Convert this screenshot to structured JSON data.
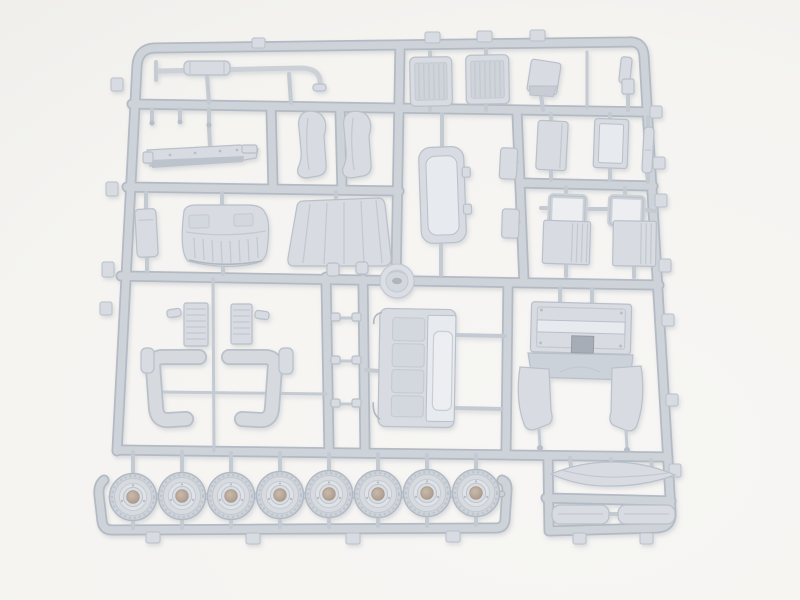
{
  "scene": {
    "type": "product-photo",
    "subject": "plastic-model-kit-sprue",
    "description": "Unpainted light-gray injection-molded sprue (parts tree) for a truck model kit on a plain white background. No text is visible in the image.",
    "colors": {
      "bg": "#f5f4f1",
      "bg_edge": "#ecebe8",
      "runner_dark": "#b3bac4",
      "runner_light": "#ced3da",
      "gate": "#c4cad2",
      "part_base": "#d8dce2",
      "part_light": "#e7eaee",
      "part_edge": "#b9c0c9",
      "detail_line": "#c3c9d1",
      "slot_dark": "#a6adb6",
      "hub_bore": "#b3a294",
      "shadow": "#9aa1ac"
    },
    "wheel_count": 8,
    "parts": [
      {
        "name": "exhaust-pipe-assembly",
        "count": 1
      },
      {
        "name": "radiator-grille",
        "count": 2
      },
      {
        "name": "small-door-panel",
        "count": 1
      },
      {
        "name": "small-bracket",
        "count": 2
      },
      {
        "name": "chassis-plate",
        "count": 1
      },
      {
        "name": "seat-back",
        "count": 2
      },
      {
        "name": "door-inner-panel",
        "count": 1
      },
      {
        "name": "small-box",
        "count": 2
      },
      {
        "name": "cab-side-panel",
        "count": 2
      },
      {
        "name": "pillar-strip",
        "count": 1
      },
      {
        "name": "battery-box",
        "count": 1
      },
      {
        "name": "cab-roof",
        "count": 1
      },
      {
        "name": "windshield-cowl",
        "count": 1
      },
      {
        "name": "hub-disc",
        "count": 1
      },
      {
        "name": "window-frame",
        "count": 2
      },
      {
        "name": "vent-panel",
        "count": 2
      },
      {
        "name": "front-fender",
        "count": 2
      },
      {
        "name": "radiator-core",
        "count": 2
      },
      {
        "name": "grab-handle",
        "count": 3
      },
      {
        "name": "door-with-windows",
        "count": 1
      },
      {
        "name": "cab-floor-assembly",
        "count": 1
      },
      {
        "name": "rear-mudguard",
        "count": 2
      },
      {
        "name": "sun-visor",
        "count": 1
      },
      {
        "name": "mud-flap",
        "count": 2
      },
      {
        "name": "wheel",
        "count": 8
      }
    ]
  }
}
